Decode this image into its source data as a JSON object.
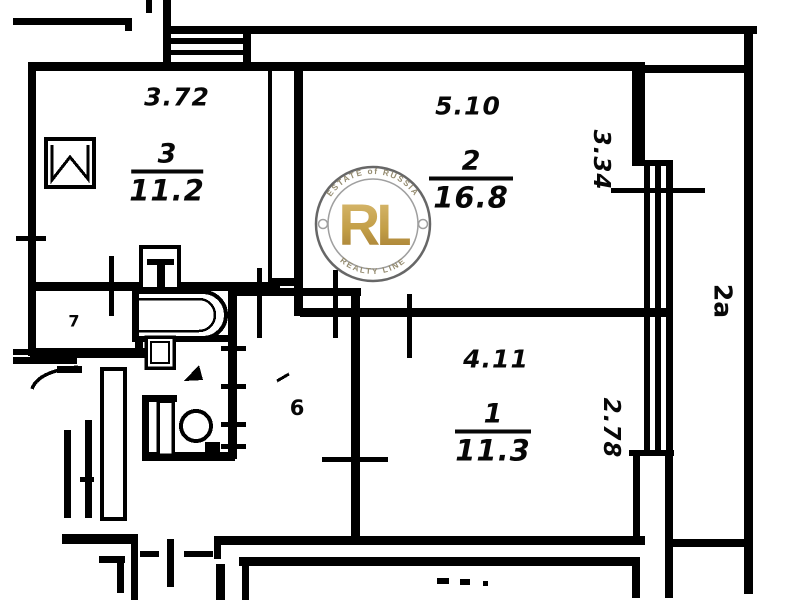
{
  "plan": {
    "rooms": [
      {
        "number": "3",
        "area": "11.2",
        "width_dim": "3.72"
      },
      {
        "number": "2",
        "area": "16.8",
        "width_dim": "5.10",
        "depth_dim": "3.34"
      },
      {
        "number": "1",
        "area": "11.3",
        "width_dim": "4.11",
        "depth_dim": "2.78"
      }
    ],
    "hall_number": "6",
    "storage_number": "7",
    "balcony_label": "2a",
    "wall_color": "#000000",
    "paper_color": "#ffffff"
  },
  "watermark": {
    "initials": "RL",
    "top_text": "ESTATE of RUSSIA",
    "bottom_text": "REALTY LINE",
    "gold_color": "#c09a3e",
    "ring_color": "#5f5f5f"
  }
}
